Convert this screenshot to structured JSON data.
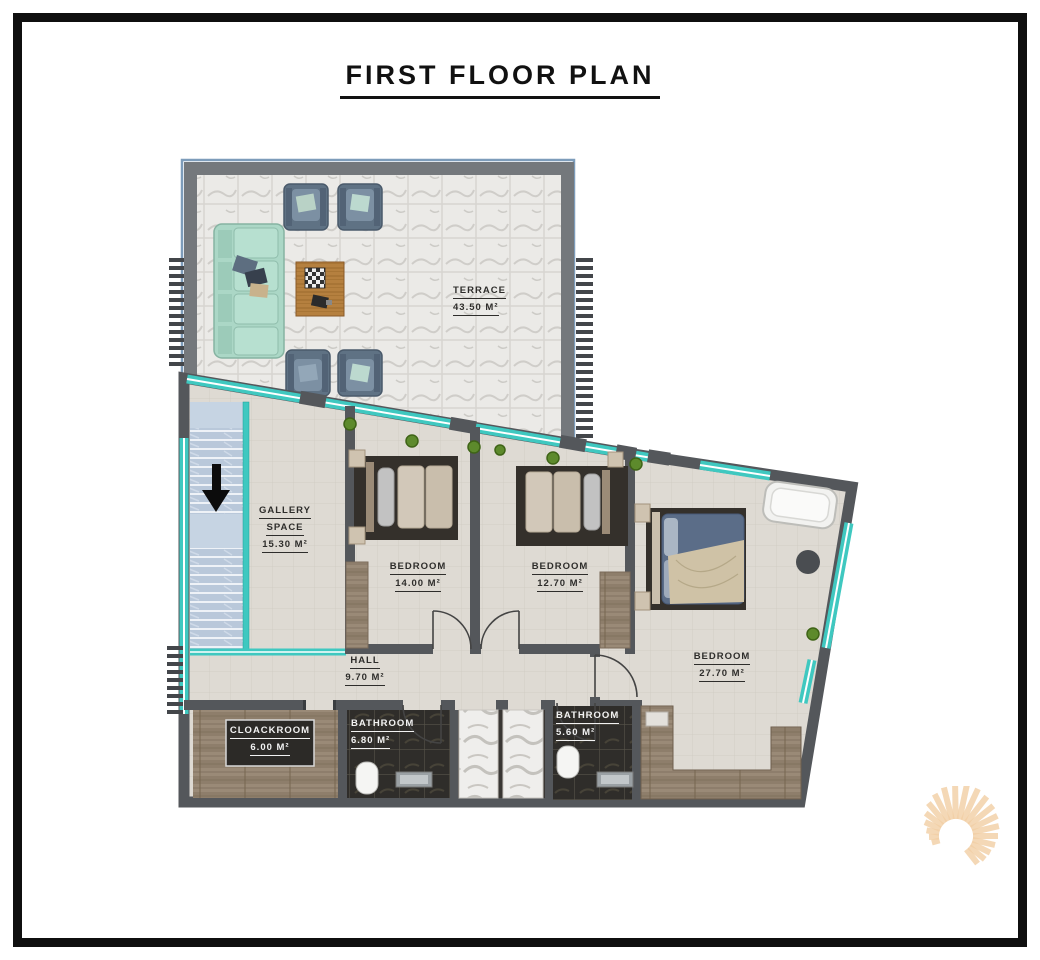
{
  "title": "FIRST FLOOR PLAN",
  "rooms": {
    "terrace": {
      "name": "TERRACE",
      "area": "43.50 M²"
    },
    "gallery": {
      "name": "GALLERY",
      "name2": "SPACE",
      "area": "15.30 M²"
    },
    "bedroom1": {
      "name": "BEDROOM",
      "area": "14.00 M²"
    },
    "bedroom2": {
      "name": "BEDROOM",
      "area": "12.70 M²"
    },
    "bedroom3": {
      "name": "BEDROOM",
      "area": "27.70 M²"
    },
    "hall": {
      "name": "HALL",
      "area": "9.70 M²"
    },
    "cloackroom": {
      "name": "CLOACKROOM",
      "area": "6.00 M²"
    },
    "bathroom1": {
      "name": "BATHROOM",
      "area": "6.80 M²"
    },
    "bathroom2": {
      "name": "BATHROOM",
      "area": "5.60 M²"
    }
  },
  "icons": {
    "stairs_arrow": "down-arrow",
    "logo": "sun-rays-spiral"
  },
  "colors": {
    "glass_teal": "#3FC8C0",
    "wall_gray": "#54575B",
    "floor": "#DEDAD3",
    "marble": "#EBEAE7",
    "dark_tile": "#2F2D2A",
    "wood": "#9A8A77",
    "stairs": "#B9C8DA",
    "sofa_mint": "#A9D6C5",
    "armchair_blue": "#5E7183",
    "logo_orange": "#F2CFA5",
    "frame_black": "#0F0F0F"
  }
}
